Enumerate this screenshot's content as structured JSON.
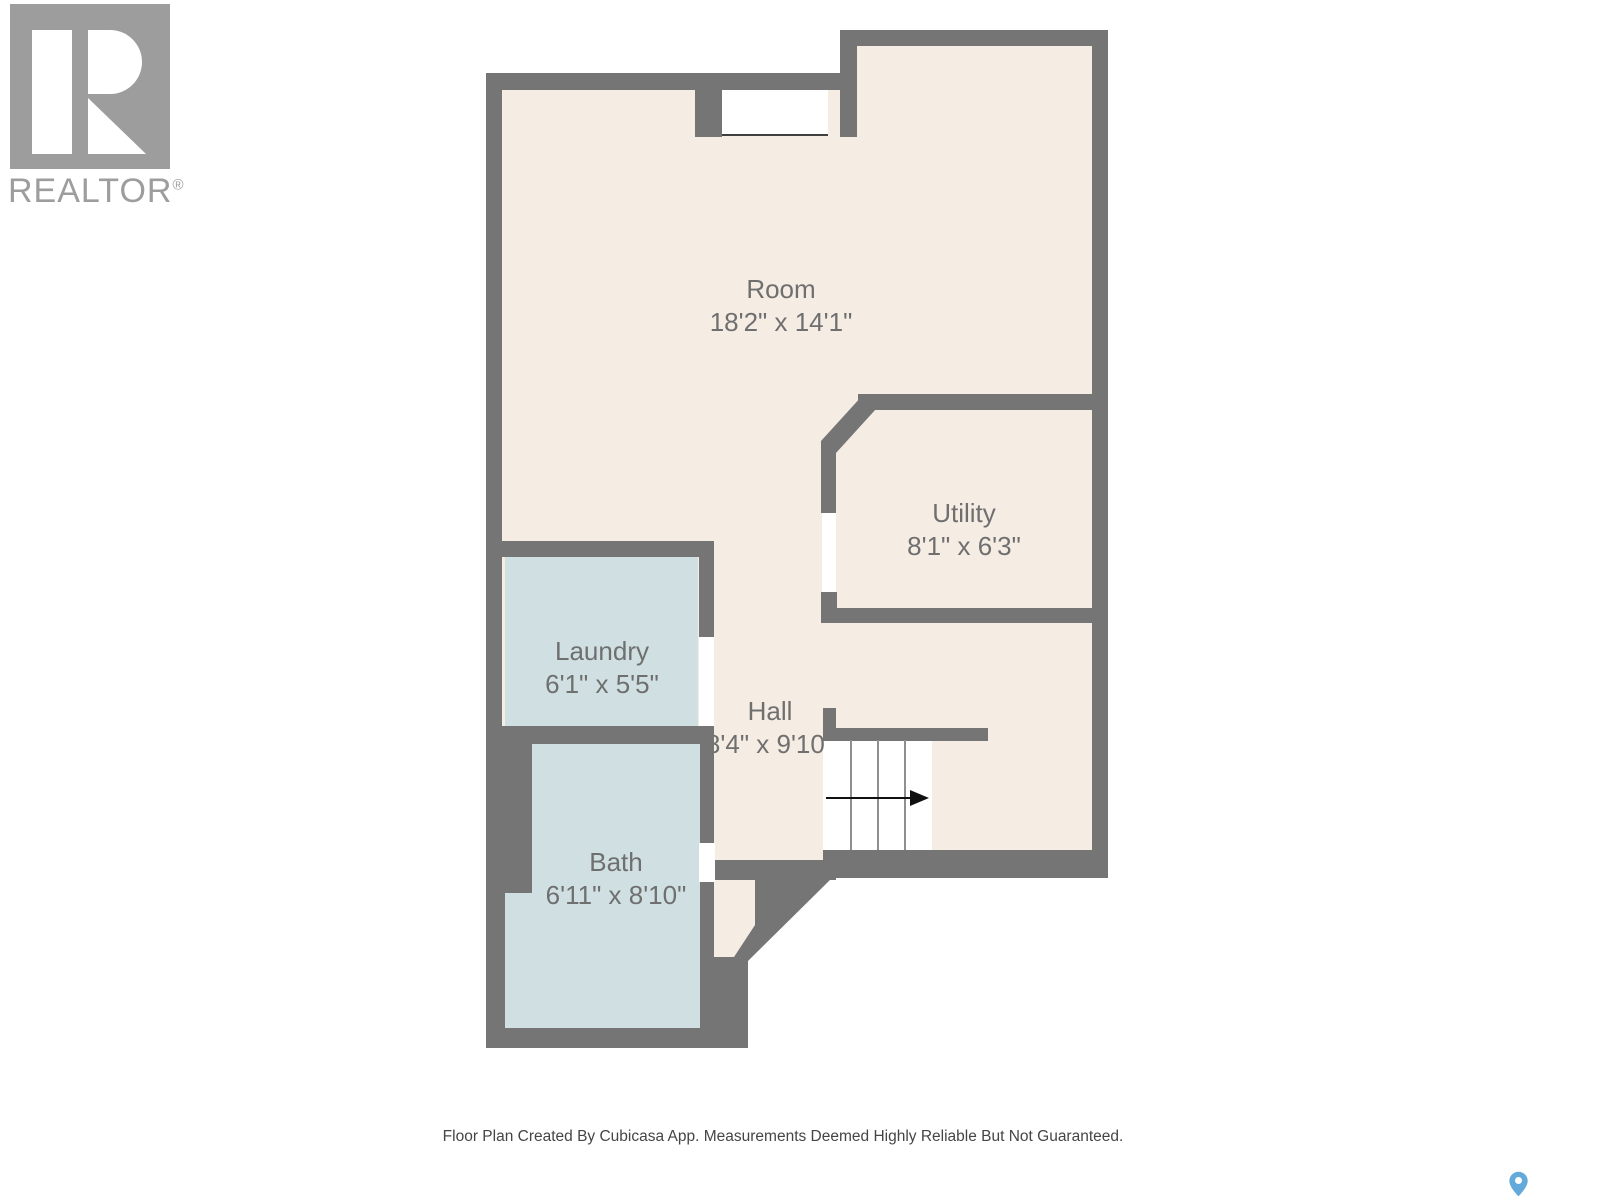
{
  "branding": {
    "logo_text": "REALTOR",
    "registered_mark": "®"
  },
  "rooms": [
    {
      "id": "room",
      "name": "Room",
      "dimensions": "18'2\" x 14'1\""
    },
    {
      "id": "utility",
      "name": "Utility",
      "dimensions": "8'1\" x 6'3\""
    },
    {
      "id": "laundry",
      "name": "Laundry",
      "dimensions": "6'1\" x 5'5\""
    },
    {
      "id": "hall",
      "name": "Hall",
      "dimensions": "8'4\" x 9'10\""
    },
    {
      "id": "bath",
      "name": "Bath",
      "dimensions": "6'11\" x 8'10\""
    }
  ],
  "stairs": {
    "direction_icon": "right-arrow",
    "tread_count": 4
  },
  "footer": {
    "disclaimer": "Floor Plan Created By Cubicasa App. Measurements Deemed Highly Reliable But Not Guaranteed."
  },
  "icons": {
    "location_pin": "map-pin",
    "realtor_block_r": "realtor-logo"
  },
  "colors": {
    "wall": "#757575",
    "floor": "#f5ece4",
    "wet-floor": "#d0e0e2",
    "label": "#6f6f6f",
    "logo": "#9d9d9d",
    "footer-text": "#454545",
    "pin": "#63a9d9"
  }
}
